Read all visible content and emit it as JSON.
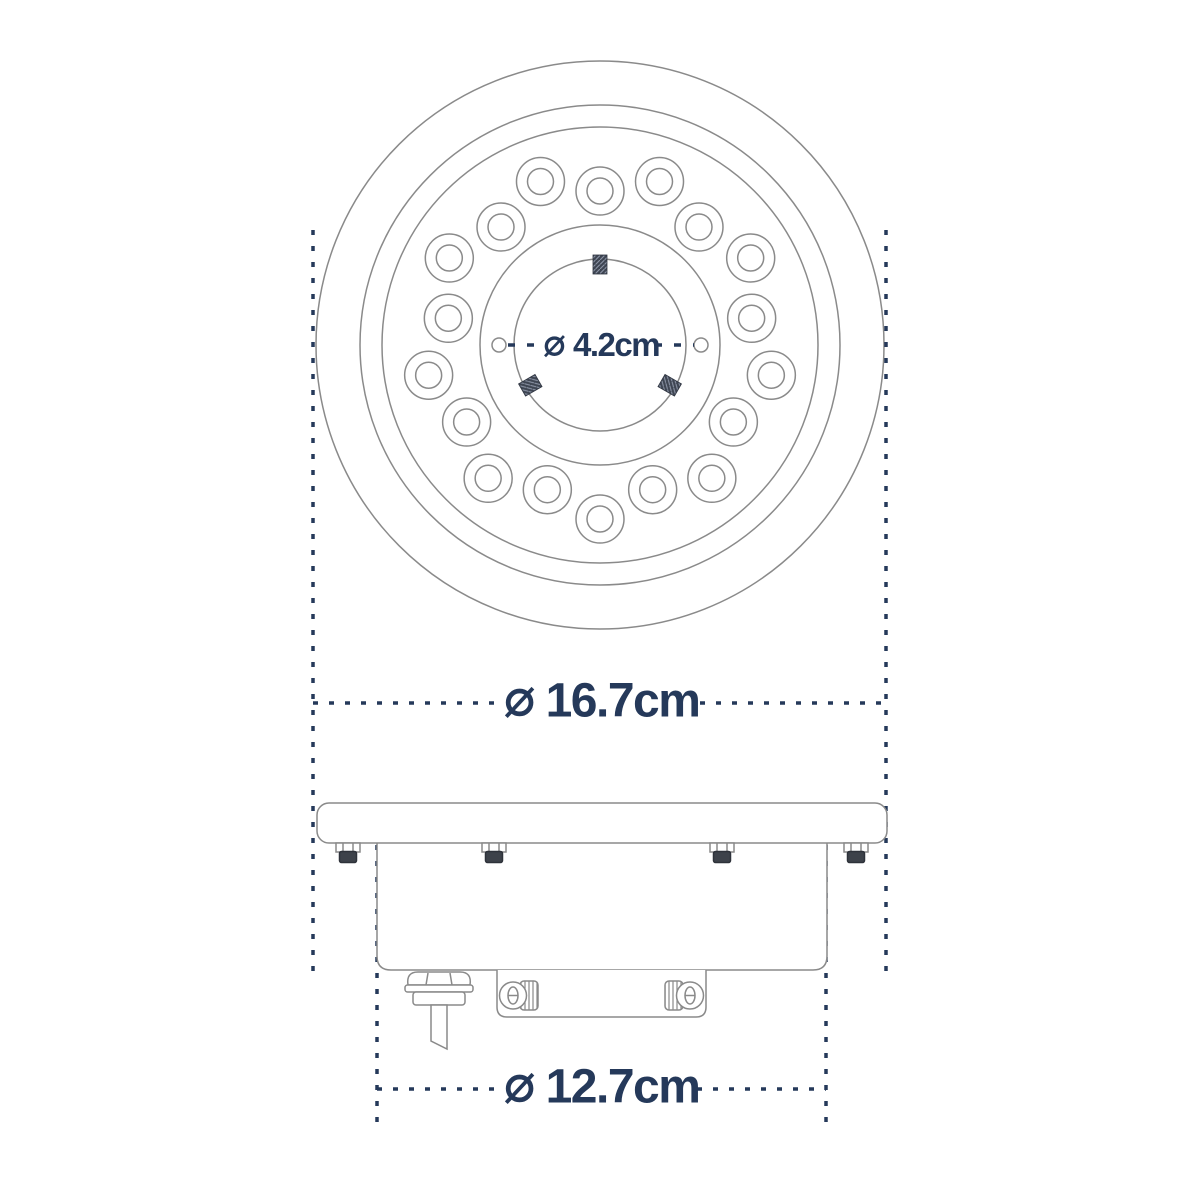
{
  "drawing": {
    "labels": {
      "hub_diameter": {
        "symbol": "⌀",
        "value": "4.2cm"
      },
      "overall_diameter": {
        "symbol": "⌀",
        "value": "16.7cm"
      },
      "body_diameter": {
        "symbol": "⌀",
        "value": "12.7cm"
      }
    },
    "top_view": {
      "center": {
        "x": 600,
        "y": 345
      },
      "plate_circle_radii_px": [
        284,
        240,
        218
      ],
      "hub_circle_radii_px": [
        120,
        86
      ],
      "led_count": 18,
      "led_ring": {
        "inner_orbit_radius_px": 154,
        "outer_orbit_radius_px": 174,
        "start_angle_deg": 90,
        "step_deg": 20,
        "led_outer_r_px": 24,
        "led_inner_r_px": 13
      },
      "pilot_holes": {
        "count": 2,
        "radius_px": 7,
        "offset_px": 101
      },
      "studs": {
        "count": 3,
        "angles_deg": [
          90,
          210,
          330
        ],
        "radial_center_px": 80.5,
        "width_px": 14,
        "length_px": 19
      }
    },
    "colors": {
      "accent": "#25395a",
      "line": "#8a8a8a",
      "hardware_dark": "#3d424a",
      "hatch_light": "#8b93a5"
    }
  }
}
